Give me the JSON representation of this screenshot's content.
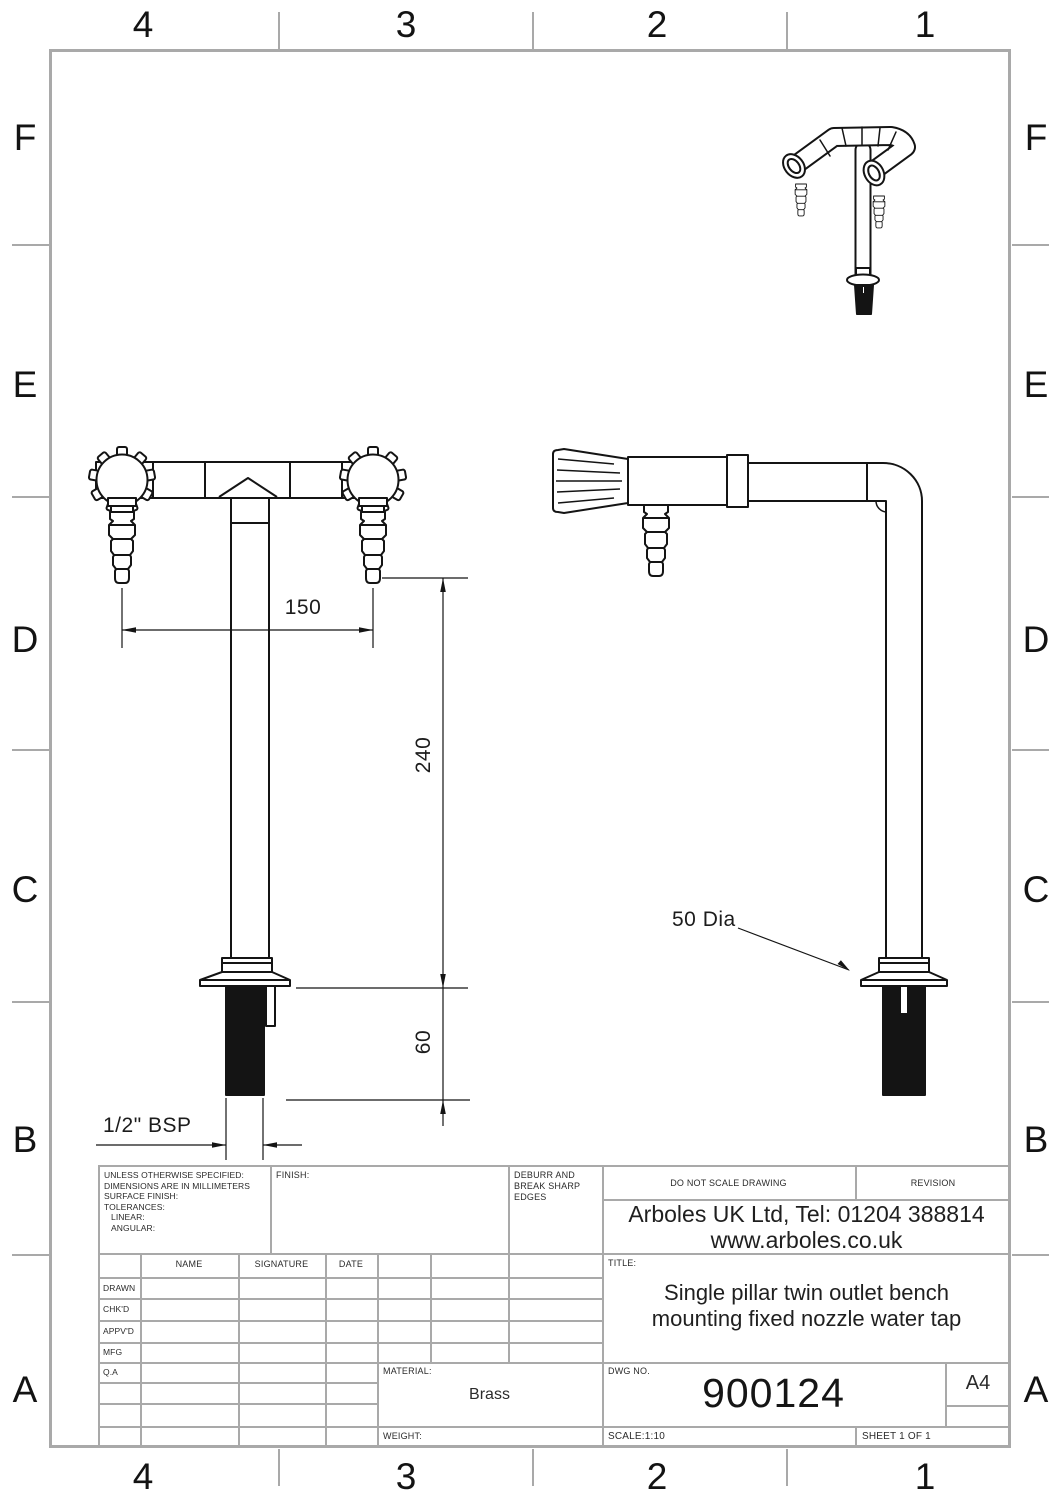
{
  "zones": {
    "columns": [
      "4",
      "3",
      "2",
      "1"
    ],
    "rows": [
      "F",
      "E",
      "D",
      "C",
      "B",
      "A"
    ]
  },
  "dimensions": {
    "span": "150",
    "height": "240",
    "thread_length": "60",
    "thread": "1/2\" BSP",
    "base_dia": "50 Dia"
  },
  "title_block": {
    "specs": {
      "l1": "UNLESS OTHERWISE SPECIFIED:",
      "l2": "DIMENSIONS ARE IN MILLIMETERS",
      "l3": "SURFACE FINISH:",
      "l4": "TOLERANCES:",
      "l5": "LINEAR:",
      "l6": "ANGULAR:"
    },
    "finish_label": "FINISH:",
    "deburr": "DEBURR AND BREAK SHARP EDGES",
    "do_not_scale": "DO NOT SCALE DRAWING",
    "revision_label": "REVISION",
    "company_line1": "Arboles UK Ltd, Tel: 01204 388814",
    "company_line2": "www.arboles.co.uk",
    "title_label": "TITLE:",
    "title_line1": "Single pillar twin outlet bench",
    "title_line2": "mounting  fixed nozzle water tap",
    "dwg_label": "DWG NO.",
    "dwg_no": "900124",
    "paper_size": "A4",
    "material_label": "MATERIAL:",
    "material_value": "Brass",
    "weight_label": "WEIGHT:",
    "scale": "SCALE:1:10",
    "sheet": "SHEET 1 OF 1",
    "table": {
      "headers": {
        "name": "NAME",
        "signature": "SIGNATURE",
        "date": "DATE"
      },
      "rows": {
        "r0": "DRAWN",
        "r1": "CHK'D",
        "r2": "APPV'D",
        "r3": "MFG",
        "r4": "Q.A"
      }
    }
  }
}
